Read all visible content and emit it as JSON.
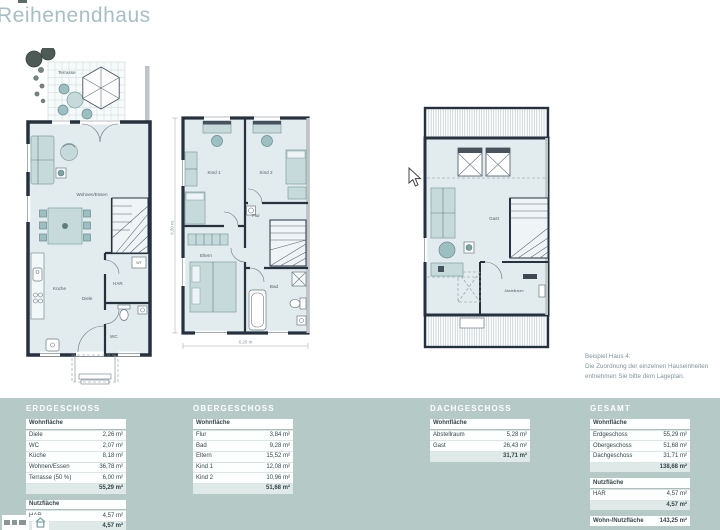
{
  "header": {
    "title": "Reihenendhaus"
  },
  "plans": {
    "erdgeschoss": {
      "rooms": {
        "terrasse": "Terrasse",
        "wohnen_essen": "Wohnen/Essen",
        "kueche": "Küche",
        "diele": "Diele",
        "har": "HAR",
        "wc": "WC",
        "wt": "WT"
      }
    },
    "obergeschoss": {
      "rooms": {
        "kind1": "Kind 1",
        "kind2": "Kind 2",
        "flur": "Flur",
        "eltern": "Eltern",
        "bad": "Bad"
      },
      "dimensions": {
        "width": "6,20 m",
        "depth": "9,30 m"
      }
    },
    "dachgeschoss": {
      "rooms": {
        "gast": "Gast",
        "abstellraum": "Abstellraum"
      }
    }
  },
  "note": {
    "line1": "Beispiel Haus 4:",
    "line2": "Die Zuordnung der einzelnen Hauseinheiten",
    "line3": "entnehmen Sie bitte dem Lageplan."
  },
  "tables": [
    {
      "id": "erdgeschoss",
      "title": "ERDGESCHOSS",
      "sections": [
        {
          "header": "Wohnfläche",
          "rows": [
            {
              "label": "Diele",
              "value": "2,26 m²"
            },
            {
              "label": "WC",
              "value": "2,07 m²"
            },
            {
              "label": "Küche",
              "value": "8,18 m²"
            },
            {
              "label": "Wohnen/Essen",
              "value": "36,78 m²"
            },
            {
              "label": "Terrasse (50 %)",
              "value": "6,00 m²"
            }
          ],
          "total": "55,29 m²"
        },
        {
          "header": "Nutzfläche",
          "rows": [
            {
              "label": "HAR",
              "value": "4,57 m²"
            }
          ],
          "total": "4,57 m²"
        }
      ]
    },
    {
      "id": "obergeschoss",
      "title": "OBERGESCHOSS",
      "sections": [
        {
          "header": "Wohnfläche",
          "rows": [
            {
              "label": "Flur",
              "value": "3,84 m²"
            },
            {
              "label": "Bad",
              "value": "9,28 m²"
            },
            {
              "label": "Eltern",
              "value": "15,52 m²"
            },
            {
              "label": "Kind 1",
              "value": "12,08 m²"
            },
            {
              "label": "Kind 2",
              "value": "10,96 m²"
            }
          ],
          "total": "51,68 m²"
        }
      ]
    },
    {
      "id": "dachgeschoss",
      "title": "DACHGESCHOSS",
      "sections": [
        {
          "header": "Wohnfläche",
          "rows": [
            {
              "label": "Abstellraum",
              "value": "5,28 m²"
            },
            {
              "label": "Gast",
              "value": "26,43 m²"
            }
          ],
          "total": "31,71 m²"
        }
      ]
    },
    {
      "id": "gesamt",
      "title": "GESAMT",
      "sections": [
        {
          "header": "Wohnfläche",
          "rows": [
            {
              "label": "Erdgeschoss",
              "value": "55,29 m²"
            },
            {
              "label": "Obergeschoss",
              "value": "51,68 m²"
            },
            {
              "label": "Dachgeschoss",
              "value": "31,71 m²"
            }
          ],
          "total": "138,68 m²"
        },
        {
          "header": "Nutzfläche",
          "rows": [
            {
              "label": "HAR",
              "value": "4,57 m²"
            }
          ],
          "total": "4,57 m²"
        }
      ],
      "summary": {
        "label": "Wohn-/Nutzfläche",
        "value": "143,25 m²"
      }
    }
  ]
}
